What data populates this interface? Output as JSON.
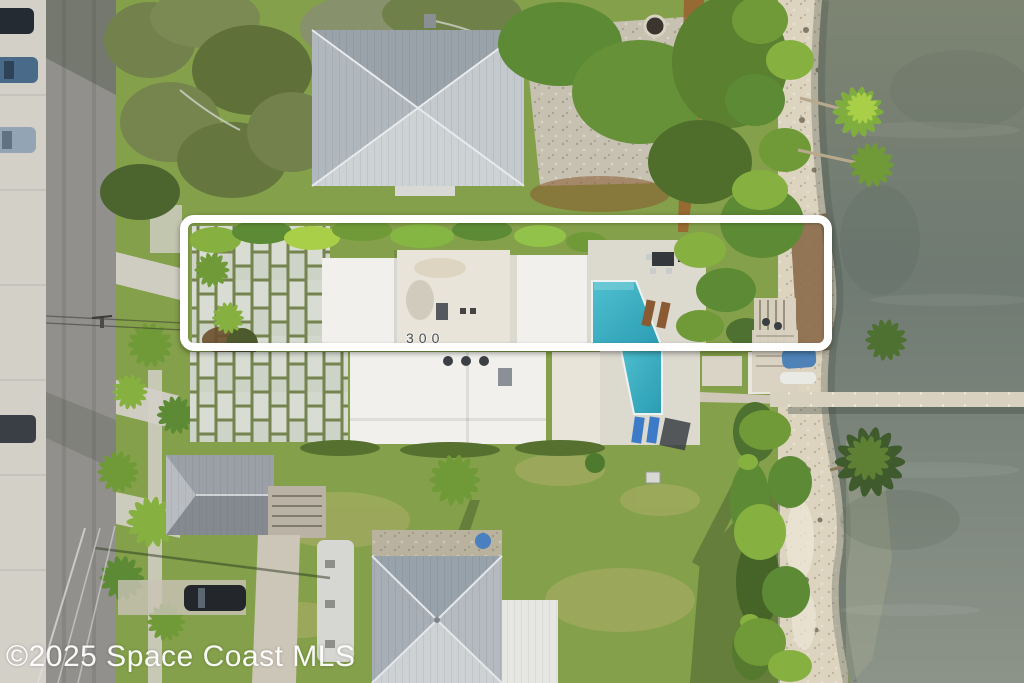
{
  "image": {
    "kind": "aerial-drone-photo",
    "scene": "Waterfront residential neighborhood; long narrow lot outlined in white between street and river"
  },
  "watermark": {
    "text": "©2025 Space Coast MLS"
  },
  "highlight_box": {
    "style": "rounded-rectangle",
    "border_color": "#ffffff"
  },
  "subject_lot": {
    "house_number": "300",
    "features": [
      "paver driveway",
      "white flat-roof house",
      "swimming pool",
      "pool deck",
      "patio furniture",
      "dock access"
    ]
  },
  "colors": {
    "concrete": "#d3d0c8",
    "road": "#91908c",
    "grass": "#84a04a",
    "lawn_light": "#aeb069",
    "tree_dark": "#4c642e",
    "tree_mid": "#5d8a35",
    "tree_bright": "#86b03f",
    "tree_olive": "#73814d",
    "water_top": "#7d8472",
    "water_mid": "#6f7a72",
    "water_bottom": "#8c9489",
    "sand": "#ddd4c0",
    "rock": "#6e6756",
    "mulch": "#9a5f2f",
    "roof_light": "#c4c9cd",
    "roof_mid": "#9aa3aa",
    "roof_dark": "#7c858d",
    "roof_white": "#f1f0ec",
    "roof_offwhite": "#e8e4d9",
    "paver": "#d8dcd3",
    "paver_joint": "#75834f",
    "pool": "#4fc0cf",
    "pool_deep": "#2b9cb3",
    "deck": "#dcd9cf",
    "dock": "#d9d1c0",
    "highlight": "#ffffff",
    "watermark": "#ffffff",
    "car_dark": "#242b33",
    "car_blue": "#4a6a8a",
    "car_silver": "#93a5b4"
  }
}
